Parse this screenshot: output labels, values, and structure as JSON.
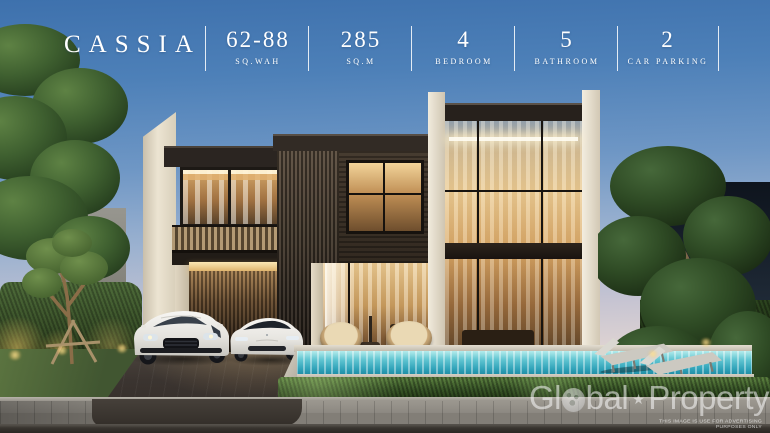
{
  "header": {
    "brand": "CASSIA",
    "specs": [
      {
        "value": "62-88",
        "label": "SQ.WAH"
      },
      {
        "value": "285",
        "label": "SQ.M"
      },
      {
        "value": "4",
        "label": "BEDROOM"
      },
      {
        "value": "5",
        "label": "BATHROOM"
      },
      {
        "value": "2",
        "label": "CAR PARKING"
      }
    ]
  },
  "watermark": {
    "part1": "Gl",
    "part2": "bal",
    "star": "★",
    "part3": "Property",
    "disclaimer": "THIS IMAGE IS USE FOR ADVERTISING PURPOSES ONLY"
  },
  "scene": {
    "subject": "Two-storey modern luxury pool villa rendering at dusk",
    "objects": {
      "car_left": "white Porsche SUV",
      "car_right": "white Tesla SUV",
      "pool": "turquoise swimming pool",
      "loungers": "two sun loungers",
      "chairs": "two rattan papasan chairs",
      "garden": "hedges, lawn, young tree with supports, mature trees"
    },
    "colors": {
      "sky_top": "#3e71ad",
      "sky_horizon": "#f0e1d5",
      "wood_cladding": "#3a2f26",
      "cream_wall": "#e7dfcd",
      "window_glow": "#e0a964",
      "pool_water": "#53bccb",
      "hedge_green": "#35512a",
      "pavement": "#45403d",
      "text_white": "#ffffff"
    }
  }
}
